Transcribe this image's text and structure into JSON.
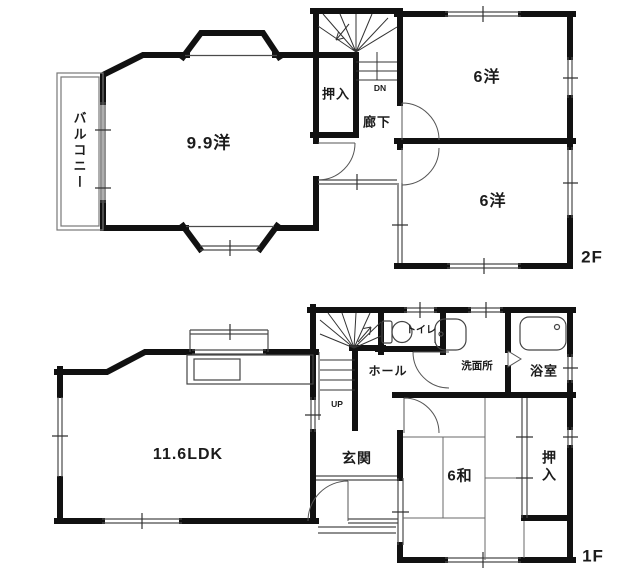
{
  "colors": {
    "wall": "#111111",
    "thin_line": "#4a4a4a",
    "light_line": "#8b8b8b",
    "text": "#1b1b1b",
    "background": "#ffffff"
  },
  "floor_2f": {
    "floor_label": "2F",
    "rooms": {
      "western_9_9": {
        "label": "9.9洋"
      },
      "balcony": {
        "label": "バルコニー"
      },
      "closet": {
        "label": "押入"
      },
      "corridor": {
        "label": "廊下"
      },
      "stairs_down": {
        "label": "DN"
      },
      "western_6_upper": {
        "label": "6洋"
      },
      "western_6_lower": {
        "label": "6洋"
      }
    }
  },
  "floor_1f": {
    "floor_label": "1F",
    "rooms": {
      "ldk": {
        "label": "11.6LDK"
      },
      "hall": {
        "label": "ホール"
      },
      "stairs_up": {
        "label": "UP"
      },
      "toilet": {
        "label": "トイレ"
      },
      "washroom": {
        "label": "洗面所"
      },
      "bathroom": {
        "label": "浴室"
      },
      "entrance": {
        "label": "玄関"
      },
      "japanese_6": {
        "label": "6和"
      },
      "closet": {
        "label": "押入"
      }
    }
  }
}
